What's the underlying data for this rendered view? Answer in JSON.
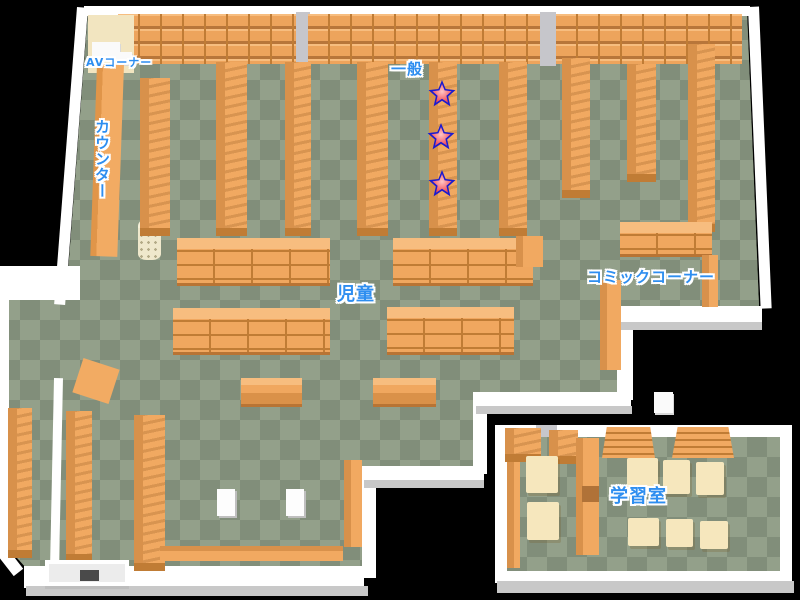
{
  "map": {
    "labels": {
      "av_corner": "AVコーナー",
      "counter": "カウンター",
      "general": "一般",
      "children": "児童",
      "comic_corner": "コミックコーナー",
      "study_room": "学習室"
    },
    "markers": {
      "shape": "star",
      "count": 3,
      "positions": [
        {
          "x": 442,
          "y": 94
        },
        {
          "x": 441,
          "y": 137
        },
        {
          "x": 442,
          "y": 184
        }
      ]
    },
    "colors": {
      "background": "#000000",
      "floor_light": "#93a08a",
      "floor_dark": "#818e7a",
      "wall": "#ffffff",
      "shelf": "#f0a75f",
      "shelf_edge": "#c07c35",
      "desk": "#f6e7bd",
      "label_text": "#2e8ef0",
      "star_outline": "#1b1bd0",
      "star_fill": "#e8354d"
    }
  }
}
